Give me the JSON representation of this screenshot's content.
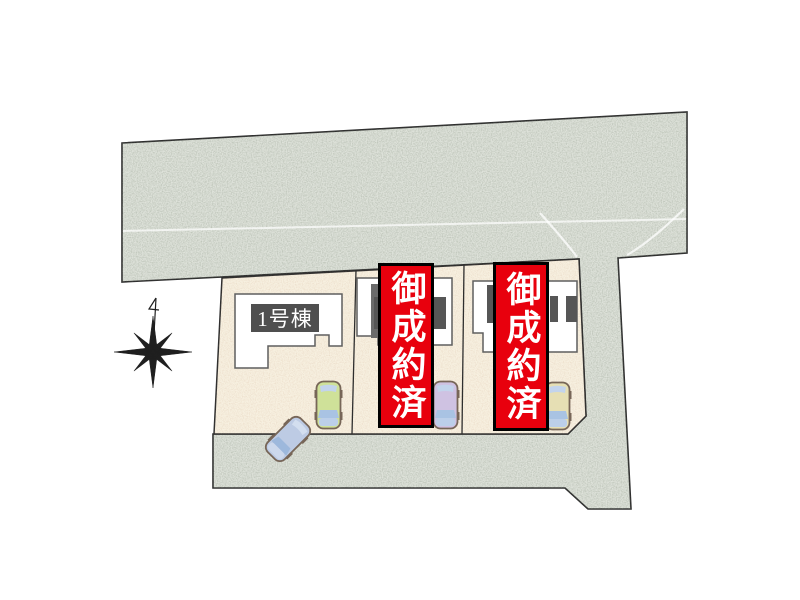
{
  "site_plan": {
    "building_label": "1号棟",
    "banners": [
      {
        "text": "御成約済"
      },
      {
        "text": "御成約済"
      }
    ],
    "cars": [
      {
        "name": "car-green",
        "color": "#cfe199"
      },
      {
        "name": "car-purple",
        "color": "#cfc2e2"
      },
      {
        "name": "car-tan",
        "color": "#e6dfb4"
      },
      {
        "name": "car-blue-angled",
        "color": "#bdcbe4"
      }
    ],
    "colors": {
      "banner_red": "#e8000d",
      "banner_border": "#000000",
      "banner_text": "#ffffff",
      "label_box_bg": "#4f4f4f",
      "label_box_text": "#ffffff",
      "road_fill": "#dee2da",
      "lot_fill": "#f7f0e0",
      "house_fill": "#ffffff",
      "outline": "#2e2e2e"
    }
  }
}
